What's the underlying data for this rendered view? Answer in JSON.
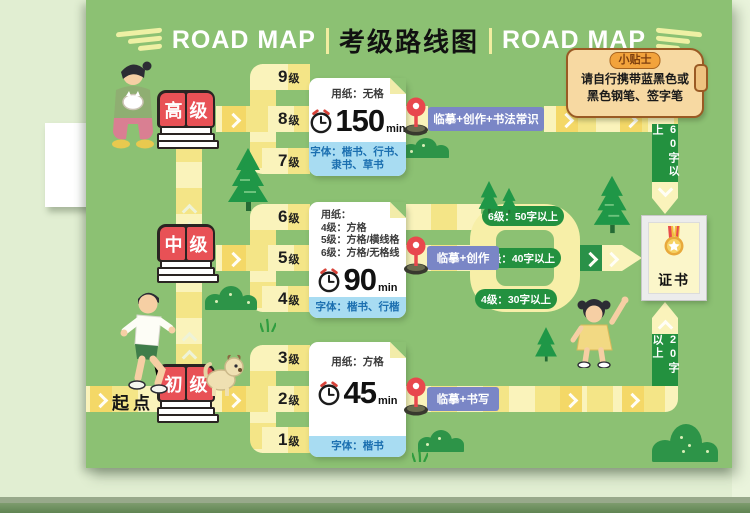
{
  "title": {
    "left": "ROAD MAP",
    "center": "考级路线图",
    "right": "ROAD MAP"
  },
  "tip": {
    "badge": "小贴士",
    "line1": "请自行携带蓝黑色或",
    "line2": "黑色钢笔、签字笔"
  },
  "start": {
    "label": "起点"
  },
  "stages": [
    {
      "name": "高级",
      "levels": [
        {
          "n": "9",
          "s": "级"
        },
        {
          "n": "8",
          "s": "级"
        },
        {
          "n": "7",
          "s": "级"
        }
      ],
      "card": {
        "paper1": "用纸：无格",
        "time": "150",
        "unit": "min",
        "font1": "字体：楷书、行书、",
        "font2": "隶书、草书"
      },
      "route": "临摹+创作+书法常识"
    },
    {
      "name": "中级",
      "levels": [
        {
          "n": "6",
          "s": "级"
        },
        {
          "n": "5",
          "s": "级"
        },
        {
          "n": "4",
          "s": "级"
        }
      ],
      "card": {
        "paper1": "用纸：",
        "paper2": "4级：方格",
        "paper3": "5级：方格/横线格",
        "paper4": "6级：方格/无格线",
        "time": "90",
        "unit": "min",
        "font1": "字体：楷书、行楷"
      },
      "route": "临摹+创作",
      "pills": [
        "6级：50字以上",
        "5级：40字以上",
        "4级：30字以上"
      ]
    },
    {
      "name": "初级",
      "levels": [
        {
          "n": "3",
          "s": "级"
        },
        {
          "n": "2",
          "s": "级"
        },
        {
          "n": "1",
          "s": "级"
        }
      ],
      "card": {
        "paper1": "用纸：方格",
        "time": "45",
        "unit": "min",
        "font1": "字体：楷书"
      },
      "route": "临摹+书写"
    }
  ],
  "side": {
    "top": "60字以上",
    "bottom": "20字以上"
  },
  "certificate": {
    "label": "证书"
  },
  "colors": {
    "poster_green": "#8cc173",
    "path_yellow": "#faf3bb",
    "path_dark": "#f4e587",
    "tile_gold": "#f4d867",
    "stage_green": "#23913f",
    "route_blue": "#7a86c6",
    "book_red": "#e85156",
    "card_footer_blue": "#a8dcf2",
    "tip_tan": "#f7d9a2"
  }
}
